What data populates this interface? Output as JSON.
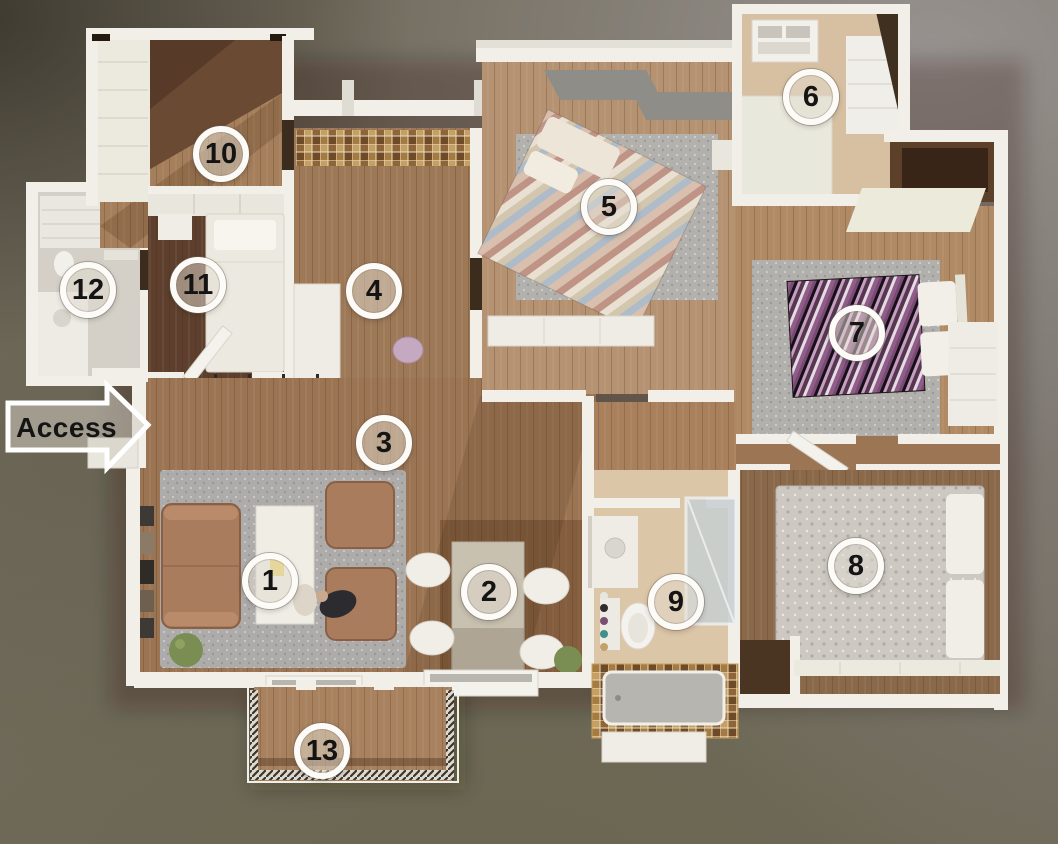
{
  "scene": {
    "description": "3D top-down rendered floor plan of a house with 13 numbered areas and an access arrow",
    "access_label": "Access"
  },
  "markers": [
    {
      "label": "1",
      "x": 270,
      "y": 581
    },
    {
      "label": "2",
      "x": 489,
      "y": 592
    },
    {
      "label": "3",
      "x": 384,
      "y": 443
    },
    {
      "label": "4",
      "x": 374,
      "y": 291
    },
    {
      "label": "5",
      "x": 609,
      "y": 207
    },
    {
      "label": "6",
      "x": 811,
      "y": 97
    },
    {
      "label": "7",
      "x": 857,
      "y": 333
    },
    {
      "label": "8",
      "x": 856,
      "y": 566
    },
    {
      "label": "9",
      "x": 676,
      "y": 602
    },
    {
      "label": "10",
      "x": 221,
      "y": 154
    },
    {
      "label": "11",
      "x": 198,
      "y": 285
    },
    {
      "label": "12",
      "x": 88,
      "y": 290
    },
    {
      "label": "13",
      "x": 322,
      "y": 751
    }
  ],
  "marker_style": {
    "ring_color": "#fcfbf8",
    "fill": "rgba(226,219,207,0.5)",
    "number_color": "#141414"
  },
  "palette": {
    "background_gray": "#969190",
    "background_olive": "#6c6852",
    "background_dark": "#4c463d",
    "wall_white": "#f2efe9",
    "wood_mid": "#9b7453",
    "wood_dark": "#5e3f2d",
    "wood_light": "#b59272",
    "floor_pale": "#d7c0a2",
    "rug_gray": "#b0aeaa",
    "cubby_purple": "#ad5f91",
    "cubby_tan": "#d9c4a4",
    "cubby_orange": "#e0862e",
    "cubby_yellow": "#eccb43",
    "cubby_green": "#a2ba57",
    "bed7_purple": "#56374f",
    "window_blue": "#5d82a8"
  }
}
